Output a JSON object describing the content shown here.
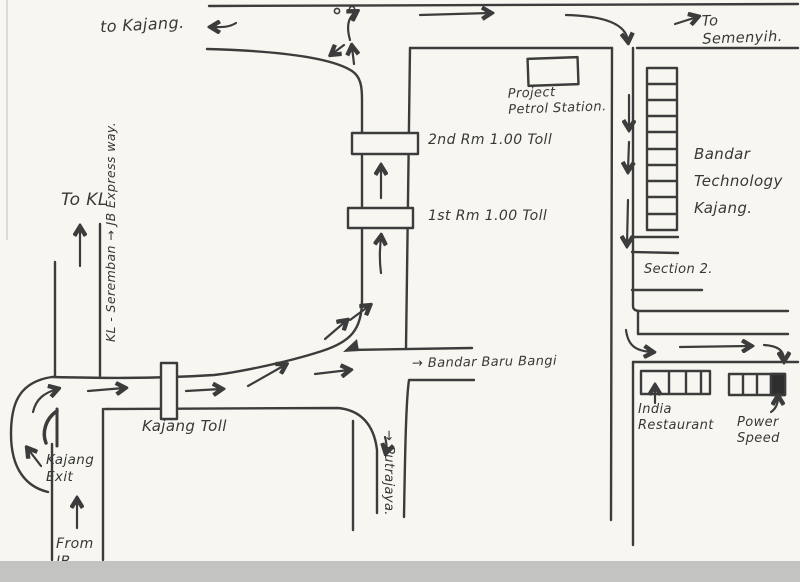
{
  "page": {
    "title": "Hand-drawn directions sketch map to Bandar Technology Kajang"
  },
  "colors": {
    "paper": "#f7f6f1",
    "ink": "#3c3c3c",
    "scan_band": "#c3c3c2",
    "filled_unit": "#2e2e2e"
  },
  "labels": {
    "to_kajang": "to Kajang.",
    "to_semenyih": "To Semenyih.",
    "project_petrol": "Project\nPetrol Station.",
    "toll_2nd": "2nd Rm 1.00 Toll",
    "toll_1st": "1st Rm 1.00 Toll",
    "bandar_tech": "Bandar\nTechnology\nKajang.",
    "section_2": "Section 2.",
    "bandar_baru": "→ Bandar Baru Bangi",
    "india_restaurant": "India\nRestaurant",
    "power_speed": "Power\nSpeed",
    "kajang_toll": "Kajang Toll",
    "kajang_exit": "Kajang\nExit",
    "from_jb": "From\nJB",
    "to_kl": "To KL",
    "kl_seremban_expressway": "KL - Seremban → JB Express way.",
    "putrajaya": "→ Putrajaya."
  }
}
